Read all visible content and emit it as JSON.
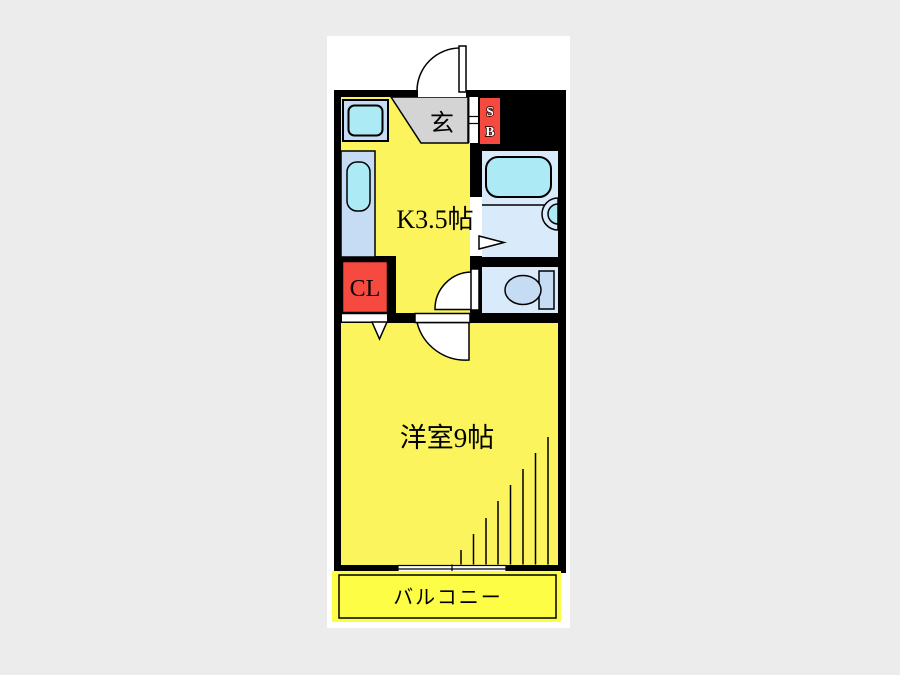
{
  "title": "apartment-floor-plan",
  "palette": {
    "page_bg": "#ececec",
    "canvas": "#ffffff",
    "wall": "#000000",
    "room_yellow": "#fbf45c",
    "balcony_yellow": "#fdfd45",
    "genkan_gray": "#d4d4d4",
    "red": "#f6493f",
    "cyan": "#aceaf6",
    "counter_blue": "#c6dcf4",
    "bath_blue": "#d9eafa"
  },
  "unit": {
    "entrance_label": "玄",
    "shoe_box_top": "S",
    "shoe_box_bottom": "B",
    "kitchen_label": "K3.5帖",
    "closet_label": "CL",
    "main_room_label": "洋室9帖",
    "balcony_label": "バルコニー"
  }
}
